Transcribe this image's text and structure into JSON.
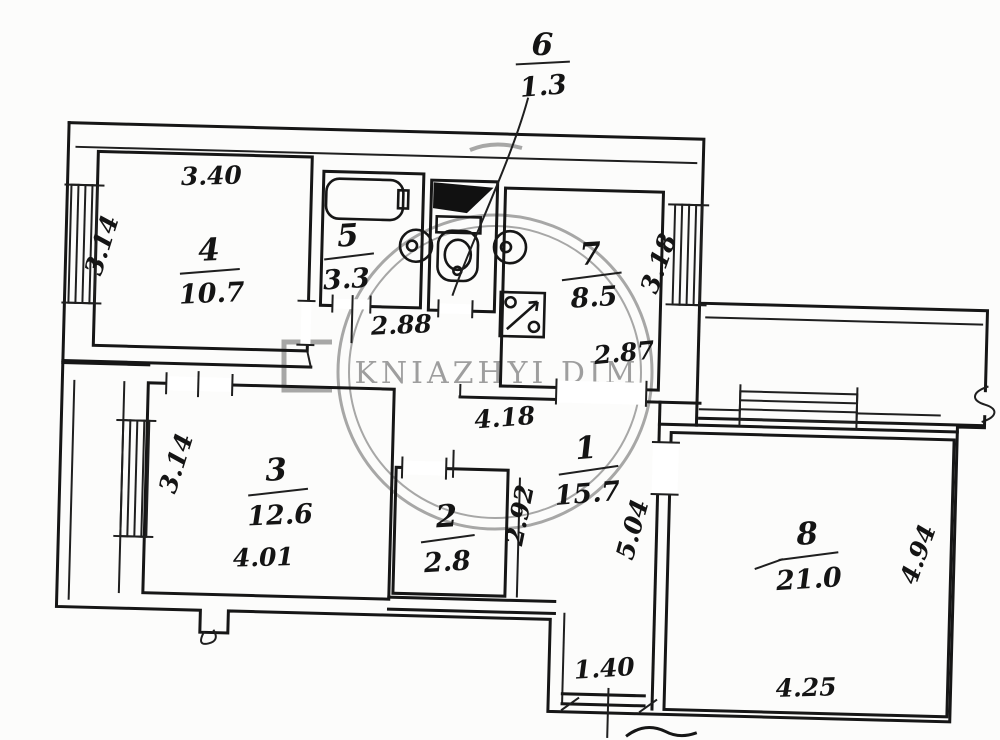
{
  "watermark": {
    "text": "KNIAZHYI DIM",
    "color": "#8d8d8d"
  },
  "rooms": {
    "r1": {
      "number": "1",
      "area": "15.7"
    },
    "r2": {
      "number": "2",
      "area": "2.8"
    },
    "r3": {
      "number": "3",
      "area": "12.6"
    },
    "r4": {
      "number": "4",
      "area": "10.7"
    },
    "r5": {
      "number": "5",
      "area": "3.3"
    },
    "r6": {
      "number": "6",
      "area": "1.3"
    },
    "r7": {
      "number": "7",
      "area": "8.5"
    },
    "r8": {
      "number": "8",
      "area": "21.0"
    }
  },
  "dims": {
    "d340": "3.40",
    "d314a": "3.14",
    "d288": "2.88",
    "d287": "2.87",
    "d318": "3.18",
    "d418": "4.18",
    "d292": "2.92",
    "d504": "5.04",
    "d314b": "3.14",
    "d401": "4.01",
    "d140": "1.40",
    "d425": "4.25",
    "d494": "4.94"
  }
}
